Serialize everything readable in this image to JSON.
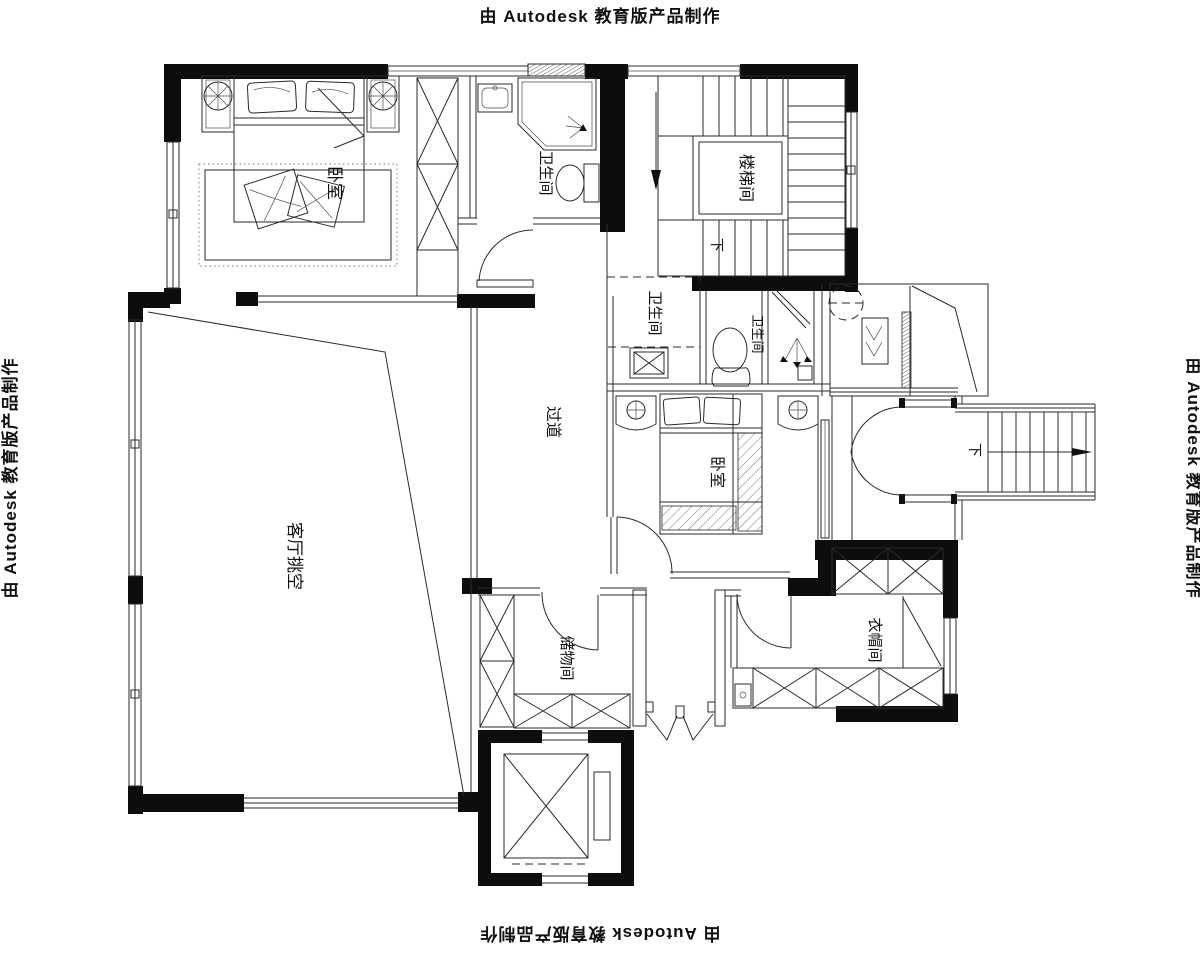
{
  "document": {
    "type": "architectural-floor-plan"
  },
  "watermark": {
    "text": "由 Autodesk 教育版产品制作"
  },
  "rooms": {
    "master_bedroom": {
      "label": "卧室"
    },
    "master_bathroom": {
      "label": "卫生间"
    },
    "stairwell": {
      "label": "楼梯间"
    },
    "upper_bathroom": {
      "label": "卫生间"
    },
    "middle_bathroom": {
      "label": "卫生间"
    },
    "hallway": {
      "label": "过道"
    },
    "second_bedroom": {
      "label": "卧室"
    },
    "living_room_void": {
      "label": "客厅挑空"
    },
    "storage_room": {
      "label": "储物间"
    },
    "cloakroom": {
      "label": "衣帽间"
    }
  },
  "stairs": {
    "down_label_interior": "下",
    "down_label_exterior": "下"
  },
  "colors": {
    "ink": "#000000",
    "paper": "#ffffff"
  }
}
